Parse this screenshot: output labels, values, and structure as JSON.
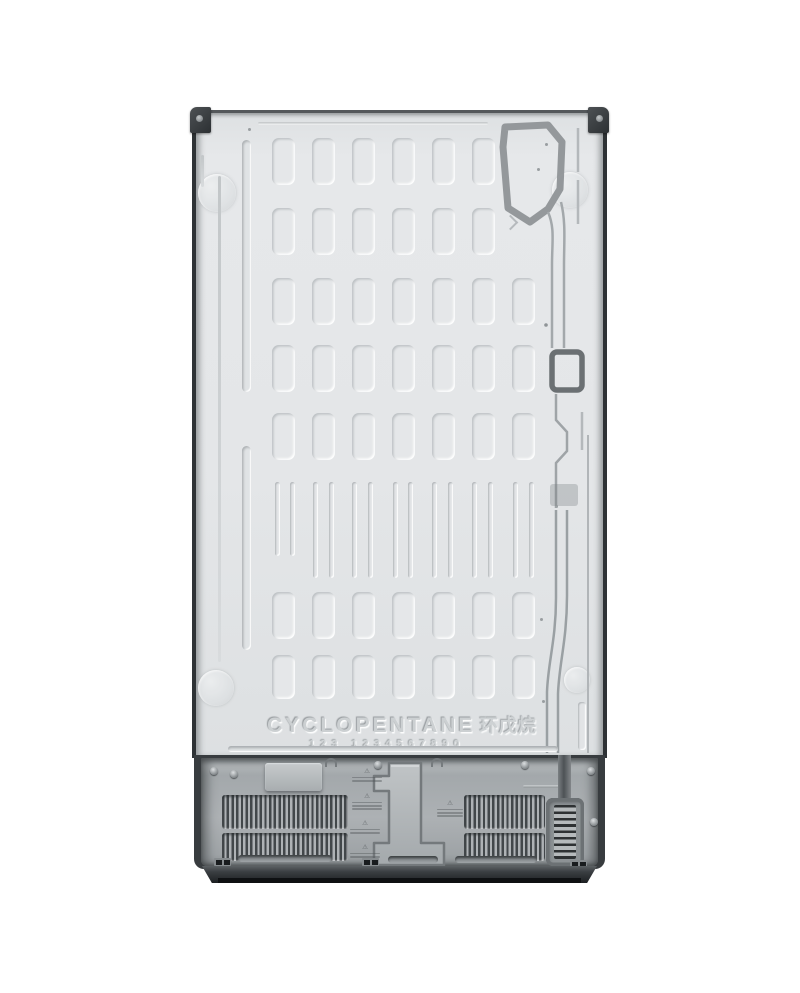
{
  "image": {
    "type": "product-photo",
    "subject": "rear view of a refrigerator back panel",
    "background_color": "#ffffff"
  },
  "embossing": {
    "refrigerant_text": "CYCLOPENTANE",
    "refrigerant_text_cn": "环戊烷",
    "serial_digits": "123 1234567890",
    "warning_icon": "⚠"
  },
  "colors": {
    "panel": "#e4e6e8",
    "panel_groove": "#bfc3c5",
    "channel": "#8f9497",
    "trim_dark": "#2e3235",
    "bracket": "#33373a",
    "compressor_face": "#a6abae",
    "grille_slat": "#42474a",
    "base": "#2a2e31"
  },
  "panel_pattern": {
    "columns_x": [
      80,
      120,
      160,
      200,
      240,
      280,
      320
    ],
    "slot_w": 23,
    "slot_h": 47,
    "rect_rows": [
      {
        "y": 28,
        "cols": [
          0,
          1,
          2,
          3,
          4,
          5
        ]
      },
      {
        "y": 98,
        "cols": [
          0,
          1,
          2,
          3,
          4,
          5
        ]
      },
      {
        "y": 168,
        "cols": [
          0,
          1,
          2,
          3,
          4,
          5,
          6
        ]
      },
      {
        "y": 235,
        "cols": [
          0,
          1,
          2,
          3,
          4,
          5,
          6
        ]
      },
      {
        "y": 303,
        "cols": [
          0,
          1,
          2,
          3,
          4,
          5,
          6
        ]
      },
      {
        "y": 482,
        "cols": [
          0,
          1,
          2,
          3,
          4,
          5,
          6
        ]
      },
      {
        "y": 545,
        "cols": [
          0,
          1,
          2,
          3,
          4,
          5,
          6
        ],
        "h": 44
      }
    ],
    "thin_band": {
      "y": 372,
      "h": 96,
      "h_short": 74,
      "pairs_x": [
        [
          83,
          98
        ],
        [
          121,
          137
        ],
        [
          160,
          176
        ],
        [
          201,
          216
        ],
        [
          240,
          256
        ],
        [
          280,
          296
        ],
        [
          321,
          337
        ]
      ]
    }
  }
}
